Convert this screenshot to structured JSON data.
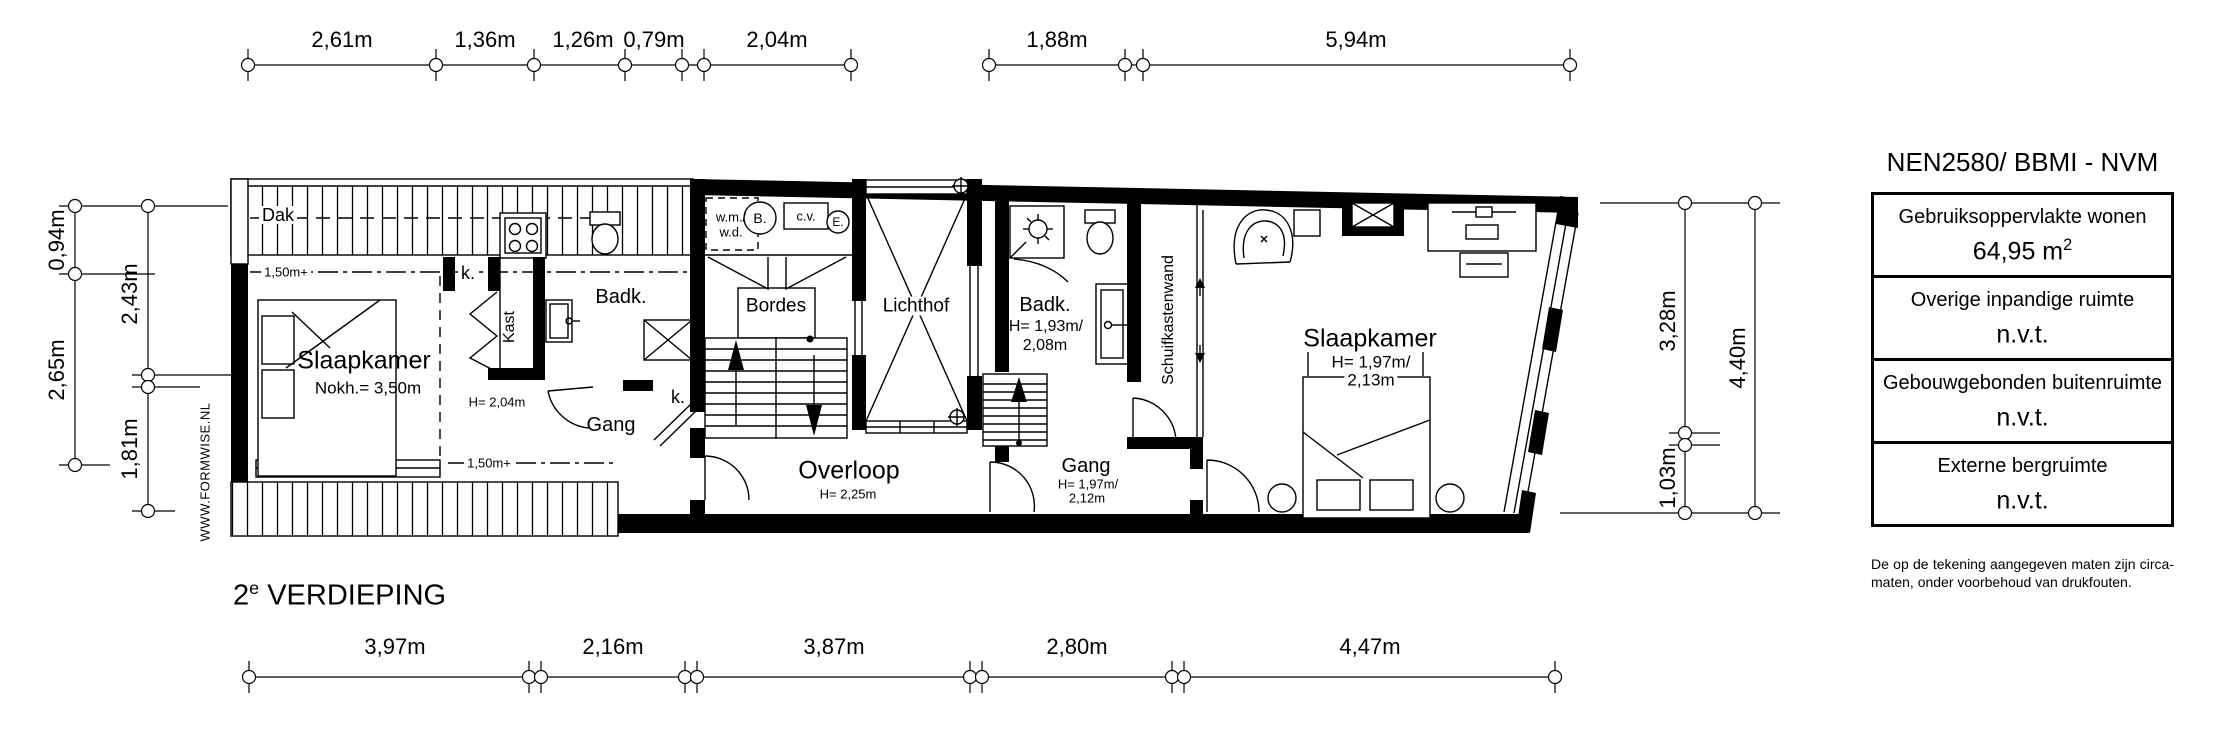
{
  "floor": {
    "number": "2",
    "sup": "e",
    "name": " VERDIEPING"
  },
  "watermark": "WWW.FORMWISE.NL",
  "dimensions": {
    "top": [
      "2,61m",
      "1,36m",
      "1,26m",
      "0,79m",
      "2,04m",
      "1,88m",
      "5,94m"
    ],
    "bottom": [
      "3,97m",
      "2,16m",
      "3,87m",
      "2,80m",
      "4,47m"
    ],
    "left_outer": [
      "0,94m",
      "2,65m"
    ],
    "left_inner": [
      "2,43m",
      "1,81m"
    ],
    "right_inner": [
      "3,28m",
      "1,03m"
    ],
    "right_outer": [
      "4,40m"
    ]
  },
  "labels": {
    "dak": "Dak",
    "roof_line_upper": "1,50m+",
    "roof_line_lower": "1,50m+",
    "slaapkamer_left": "Slaapkamer",
    "slaapkamer_left_note": "Nokh.= 3,50m",
    "closet_1": "k.",
    "closet_2": "k.",
    "kast": "Kast",
    "badkamer_left": "Badk.",
    "door_height": "H= 2,04m",
    "gang_left": "Gang",
    "washer": "w.m./",
    "dryer": "w.d.",
    "boiler_b": "B.",
    "cv": "c.v.",
    "electric": "E.",
    "bordes": "Bordes",
    "lichthof": "Lichthof",
    "overloop": "Overloop",
    "overloop_height": "H= 2,25m",
    "badkamer_right": "Badk.",
    "badkamer_right_h1": "H= 1,93m/",
    "badkamer_right_h2": "2,08m",
    "schuifkastenwand": "Schuifkastenwand",
    "gang_right": "Gang",
    "gang_right_h1": "H= 1,97m/",
    "gang_right_h2": "2,12m",
    "slaapkamer_right": "Slaapkamer",
    "slaapkamer_right_h1": "H= 1,97m/",
    "slaapkamer_right_h2": "2,13m"
  },
  "legend": {
    "title": "NEN2580/ BBMI - NVM",
    "rows": [
      {
        "label": "Gebruiksoppervlakte wonen",
        "value": "64,95 m",
        "value_sup": "2"
      },
      {
        "label": "Overige inpandige ruimte",
        "value": "n.v.t.",
        "value_sup": ""
      },
      {
        "label": "Gebouwgebonden buitenruimte",
        "value": "n.v.t.",
        "value_sup": ""
      },
      {
        "label": "Externe bergruimte",
        "value": "n.v.t.",
        "value_sup": ""
      }
    ],
    "disclaimer": "De op de tekening aangegeven maten zijn circa-maten, onder voorbehoud van drukfouten."
  }
}
